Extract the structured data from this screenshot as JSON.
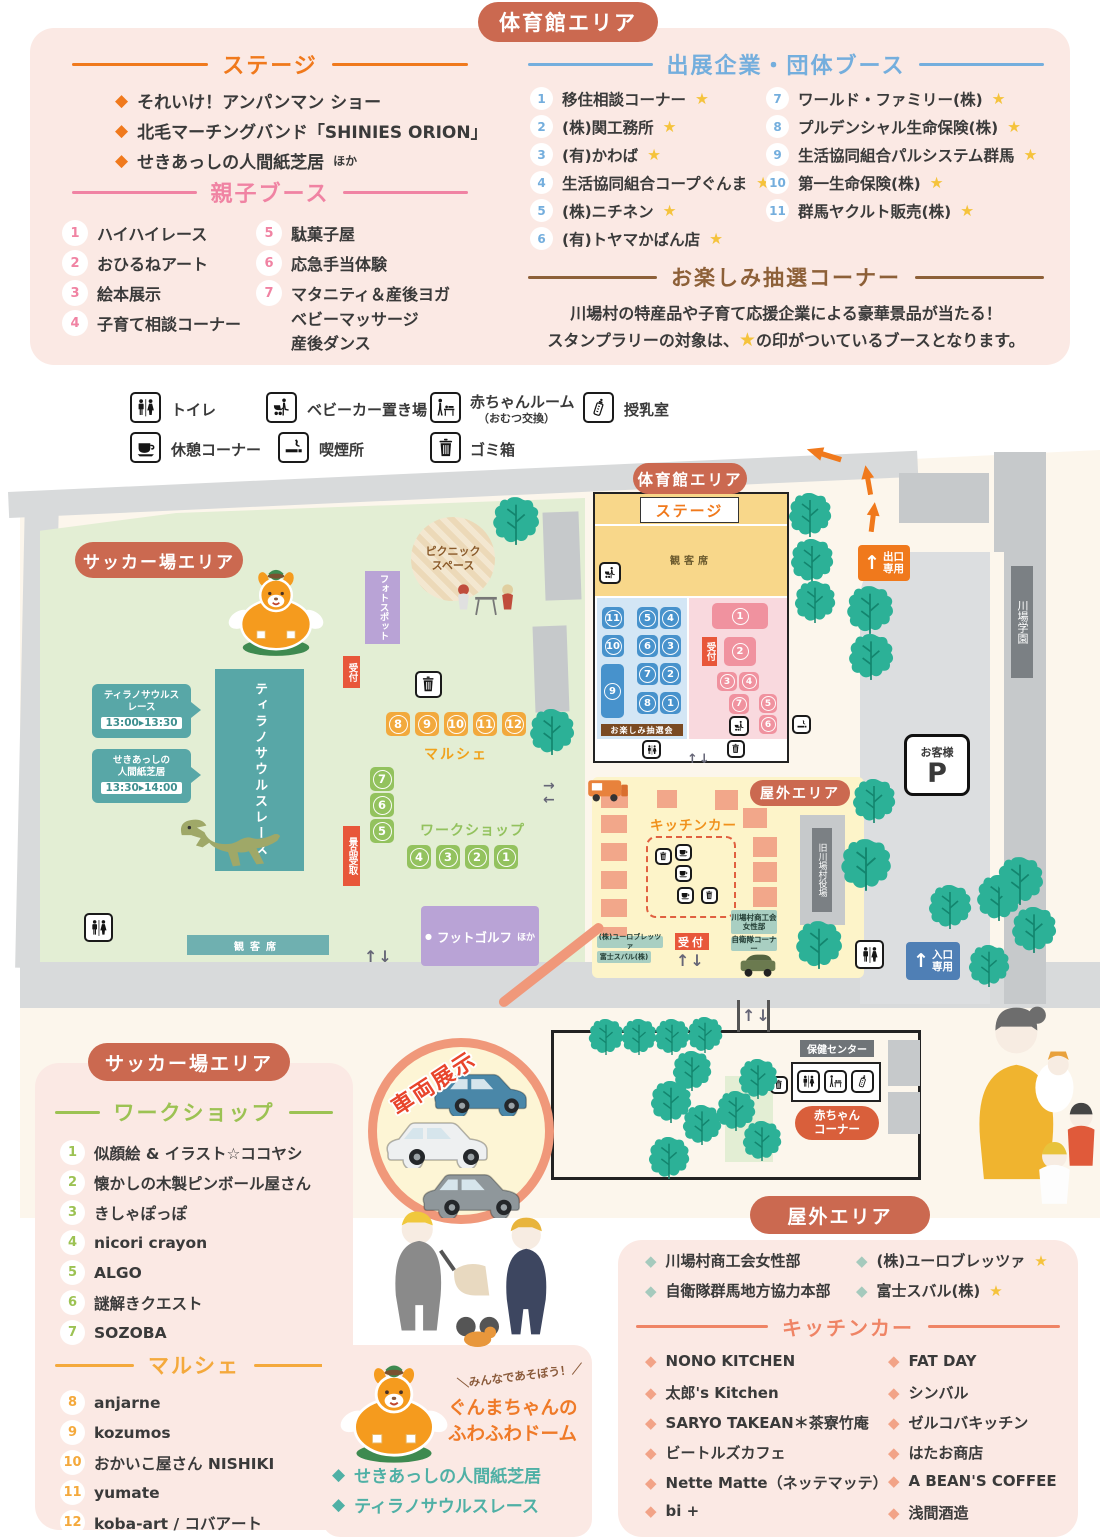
{
  "colors": {
    "area_badge": "#cb6950",
    "stage_orange": "#f0791c",
    "oyako_pink": "#f083a3",
    "exhibitor_blue": "#74aedd",
    "lottery_brown": "#8d6038",
    "teal": "#58a7a7",
    "workshop_green": "#9cc253",
    "marche_orange": "#f4a93c",
    "kitchen_salmon": "#ef8465",
    "star_yellow": "#f5c33c",
    "exit_orange": "#f0791c",
    "entrance_blue": "#4f7fb5"
  },
  "ui": {
    "diamond": "◆",
    "dot": "●",
    "up": "↑",
    "down": "↓",
    "left": "←",
    "right": "→"
  },
  "badges": {
    "gym": "体育館エリア",
    "soccer": "サッカー場エリア",
    "outdoor": "屋外エリア"
  },
  "stage_section": {
    "title": "ステージ",
    "items": [
      "それいけ！アンパンマン ショー",
      "北毛マーチングバンド「SHINIES ORION」",
      "せきあっしの人間紙芝居"
    ],
    "etc": "ほか"
  },
  "oyako_section": {
    "title": "親子ブース",
    "left": [
      [
        "1",
        "ハイハイレース"
      ],
      [
        "2",
        "おひるねアート"
      ],
      [
        "3",
        "絵本展示"
      ],
      [
        "4",
        "子育て相談コーナー"
      ]
    ],
    "right": [
      [
        "5",
        "駄菓子屋"
      ],
      [
        "6",
        "応急手当体験"
      ],
      [
        "7",
        "マタニティ＆産後ヨガ"
      ]
    ],
    "item7_extra": [
      "ベビーマッサージ",
      "産後ダンス"
    ]
  },
  "exhibitor_section": {
    "title": "出展企業・団体ブース",
    "star": "★",
    "left": [
      [
        "1",
        "移住相談コーナー"
      ],
      [
        "2",
        "(株)関工務所"
      ],
      [
        "3",
        "(有)かわば"
      ],
      [
        "4",
        "生活協同組合コープぐんま"
      ],
      [
        "5",
        "(株)ニチネン"
      ],
      [
        "6",
        "(有)トヤマかばん店"
      ]
    ],
    "right": [
      [
        "7",
        "ワールド・ファミリー(株)"
      ],
      [
        "8",
        "プルデンシャル生命保険(株)"
      ],
      [
        "9",
        "生活協同組合パルシステム群馬"
      ],
      [
        "10",
        "第一生命保険(株)"
      ],
      [
        "11",
        "群馬ヤクルト販売(株)"
      ]
    ]
  },
  "lottery_section": {
    "title": "お楽しみ抽選コーナー",
    "line1": "川場村の特産品や子育て応援企業による豪華景品が当たる！",
    "line2_pre": "スタンプラリーの対象は、",
    "line2_star": "★",
    "line2_post": "の印がついているブースとなります。"
  },
  "legend": {
    "toilet": "トイレ",
    "stroller": "ベビーカー置き場",
    "baby_room": "赤ちゃんルーム",
    "baby_room_sub": "（おむつ交換）",
    "nursing": "授乳室",
    "rest": "休憩コーナー",
    "smoking": "喫煙所",
    "trash": "ゴミ箱"
  },
  "map": {
    "reception": "受付",
    "soccer": {
      "photo_spot": "フォトスポット",
      "picnic1": "ピクニック",
      "picnic2": "スペース",
      "c1_l1": "ティラノサウルス",
      "c1_l2": "レース",
      "c1_time": "13:00▸13:30",
      "c2_l1": "せきあっしの",
      "c2_l2": "人間紙芝居",
      "c2_time": "13:30▸14:00",
      "trex_zone": "ティラノサウルスレース",
      "marche": "マルシェ",
      "marche_nums": [
        "8",
        "9",
        "10",
        "11",
        "12"
      ],
      "workshop": "ワークショップ",
      "ws_v": [
        "7",
        "6",
        "5"
      ],
      "ws_h": [
        "4",
        "3",
        "2",
        "1"
      ],
      "prize": "景品受取",
      "footgolf": "フットゴルフ",
      "footgolf_etc": "ほか",
      "seats": "観客席"
    },
    "gym": {
      "stage": "ステージ",
      "seats": "観客席",
      "lottery": "お楽しみ抽選会",
      "blue": [
        "11",
        "5",
        "4",
        "10",
        "6",
        "3",
        "9",
        "7",
        "2",
        "8",
        "1"
      ],
      "pink": [
        "1",
        "2",
        "3",
        "4",
        "7",
        "5",
        "6"
      ]
    },
    "outdoor": {
      "kitchen": "キッチンカー",
      "women1": "川場村商工会",
      "women2": "女性部",
      "jsdf": "自衛隊コーナー",
      "euro": "(株)ユーロブレッツァ",
      "subaru": "富士スバル(株)"
    },
    "right": {
      "exit1": "出口",
      "exit2": "専用",
      "ent1": "入口",
      "ent2": "専用",
      "parking_label": "お客様",
      "parking_p": "P",
      "school": "川場学園",
      "old_office": "旧川場村役場"
    },
    "health": {
      "label": "保健センター",
      "baby1": "赤ちゃん",
      "baby2": "コーナー"
    },
    "vehicle_label": "車両展示"
  },
  "soccer_panel": {
    "workshop_title": "ワークショップ",
    "workshop_items": [
      [
        "1",
        "似顔絵 & イラスト☆ココヤシ"
      ],
      [
        "2",
        "懐かしの木製ピンボール屋さん"
      ],
      [
        "3",
        "きしゃぽっぽ"
      ],
      [
        "4",
        "nicori crayon"
      ],
      [
        "5",
        "ALGO"
      ],
      [
        "6",
        "謎解きクエスト"
      ],
      [
        "7",
        "SOZOBA"
      ]
    ],
    "marche_title": "マルシェ",
    "marche_items": [
      [
        "8",
        "anjarne"
      ],
      [
        "9",
        "kozumos"
      ],
      [
        "10",
        "おかいこ屋さん NISHIKI"
      ],
      [
        "11",
        "yumate"
      ],
      [
        "12",
        "koba-art / コバアート"
      ]
    ]
  },
  "gunma_panel": {
    "burst": "＼みんなであそぼう！／",
    "name1": "ぐんまちゃんの",
    "name2": "ふわふわドーム",
    "items": [
      "せきあっしの人間紙芝居",
      "ティラノサウルスレース"
    ]
  },
  "outdoor_panel": {
    "star": "★",
    "booths_left": [
      "川場村商工会女性部",
      "自衛隊群馬地方協力本部"
    ],
    "booths_right": [
      "(株)ユーロブレッツァ",
      "富士スバル(株)"
    ],
    "kitchen_title": "キッチンカー",
    "kitchen_left": [
      "NONO KITCHEN",
      "太郎's Kitchen",
      "SARYO TAKEAN＊茶寮竹庵",
      "ビートルズカフェ",
      "Nette Matte（ネッテマッテ）",
      "bi +"
    ],
    "kitchen_right": [
      "FAT DAY",
      "シンバル",
      "ゼルコバキッチン",
      "はたお商店",
      "A BEAN'S COFFEE",
      "浅間酒造"
    ]
  }
}
